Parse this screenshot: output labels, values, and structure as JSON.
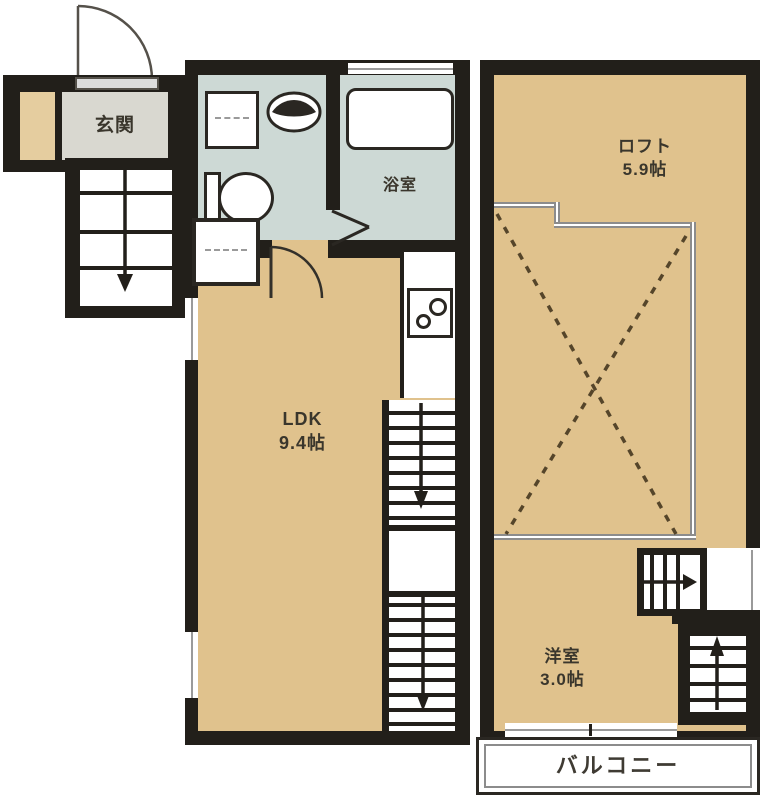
{
  "plan": {
    "type": "floor-plan",
    "rooms": {
      "entrance": {
        "name": "玄関"
      },
      "bathroom": {
        "name": "浴室"
      },
      "ldk": {
        "name": "LDK",
        "size": "9.4帖"
      },
      "loft": {
        "name": "ロフト",
        "size": "5.9帖"
      },
      "western_room": {
        "name": "洋室",
        "size": "3.0帖"
      },
      "balcony": {
        "name": "バルコニー"
      }
    },
    "colors": {
      "wall": "#221f1a",
      "floor_tan": "#e0c28d",
      "wet_area": "#cdd9d5",
      "entrance_floor": "#e5cd9f",
      "entrance_label_bg": "#d9d8d0",
      "loft_boundary_gray": "#8c8c8c",
      "dashed_line": "#55452a",
      "label_text": "#3a362c"
    }
  }
}
